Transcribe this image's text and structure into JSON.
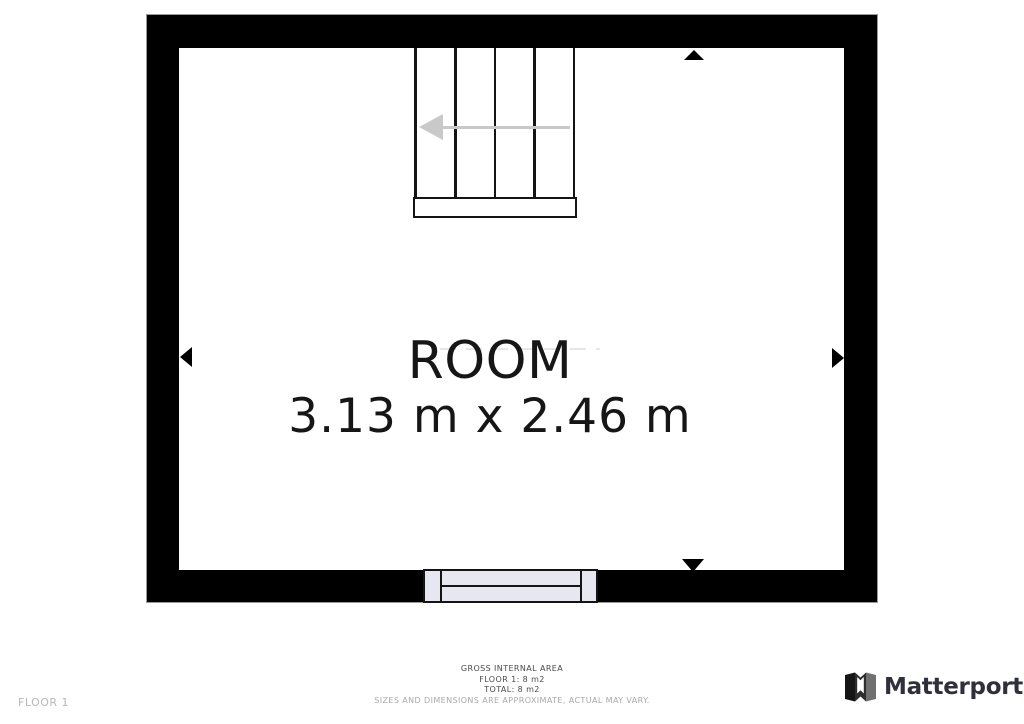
{
  "page": {
    "floor_label": "FLOOR 1"
  },
  "floorplan": {
    "room_label": "ROOM",
    "room_dimensions": "3.13 m x 2.46 m",
    "stairs_direction": "left",
    "window_position": "bottom-center-wall"
  },
  "footer": {
    "gross_area_title": "GROSS INTERNAL AREA",
    "floor_area": "FLOOR 1: 8 m2",
    "total_area": "TOTAL: 8 m2",
    "disclaimer": "SIZES AND DIMENSIONS ARE APPROXIMATE, ACTUAL MAY VARY."
  },
  "brand": {
    "name": "Matterport"
  },
  "colors": {
    "wall": "#000000",
    "window_fill": "#e7e7f2",
    "stair_arrow": "#c9c9c9",
    "dimension_arrow": "#000000",
    "footer_text": "#4a4a4a",
    "footer_muted": "#a9a9a9",
    "floor_label": "#b7b7b7",
    "brand_text": "#30303c"
  }
}
